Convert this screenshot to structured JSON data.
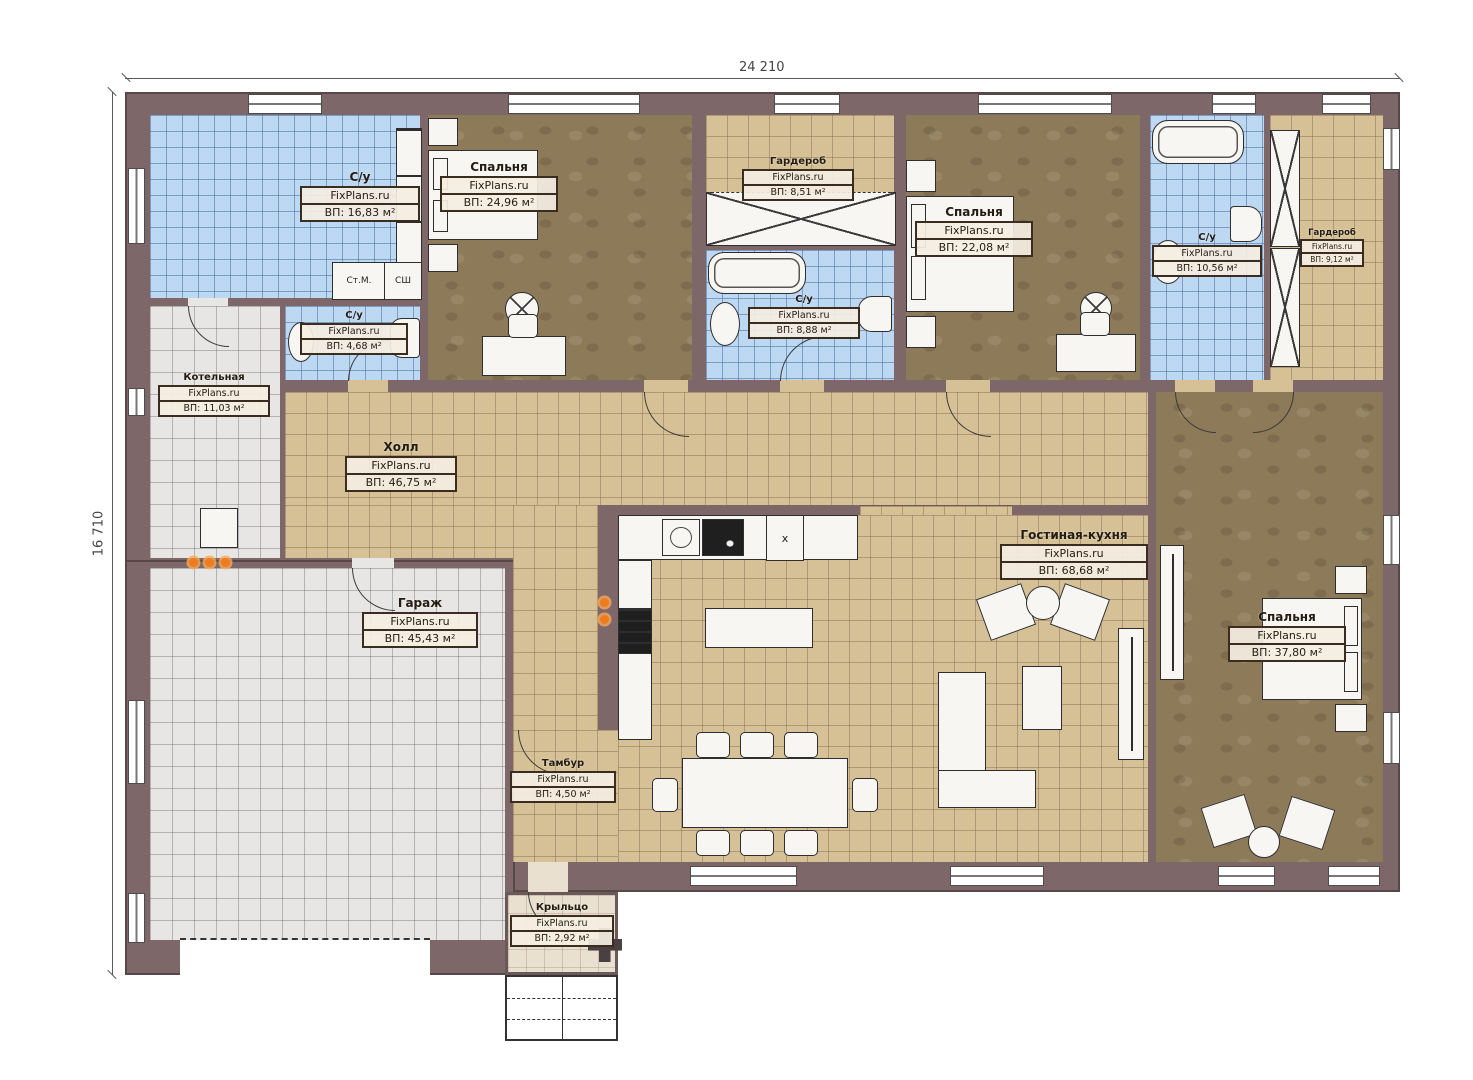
{
  "meta": {
    "watermark": "FixPlans.ru"
  },
  "dimensions": {
    "width_label": "24 210",
    "height_label": "16 710"
  },
  "rooms": [
    {
      "name": "С/у",
      "area": "ВП: 16,83 м²"
    },
    {
      "name": "Спальня",
      "area": "ВП: 24,96 м²"
    },
    {
      "name": "Гардероб",
      "area": "ВП: 8,51 м²"
    },
    {
      "name": "С/у",
      "area": "ВП: 8,88 м²"
    },
    {
      "name": "Спальня",
      "area": "ВП: 22,08 м²"
    },
    {
      "name": "С/у",
      "area": "ВП: 10,56 м²"
    },
    {
      "name": "Гардероб",
      "area": "ВП: 9,12 м²"
    },
    {
      "name": "С/у",
      "area": "ВП: 4,68 м²"
    },
    {
      "name": "Котельная",
      "area": "ВП: 11,03 м²"
    },
    {
      "name": "Холл",
      "area": "ВП: 46,75 м²"
    },
    {
      "name": "Гараж",
      "area": "ВП: 45,43 м²"
    },
    {
      "name": "Тамбур",
      "area": "ВП: 4,50 м²"
    },
    {
      "name": "Гостиная-кухня",
      "area": "ВП: 68,68 м²"
    },
    {
      "name": "Спальня",
      "area": "ВП: 37,80 м²"
    },
    {
      "name": "Крыльцо",
      "area": "ВП: 2,92 м²"
    }
  ],
  "small_labels": {
    "washer": "Ст.М.",
    "dryer": "СШ",
    "vent": "x"
  },
  "colors": {
    "wall": "#7d6769",
    "bath_tile": "#bdd8f3",
    "hall_tile": "#d5c195",
    "garage_tile": "#e7e6e4",
    "wood": "#8d7a59",
    "radiator": "#ee7b1e"
  }
}
